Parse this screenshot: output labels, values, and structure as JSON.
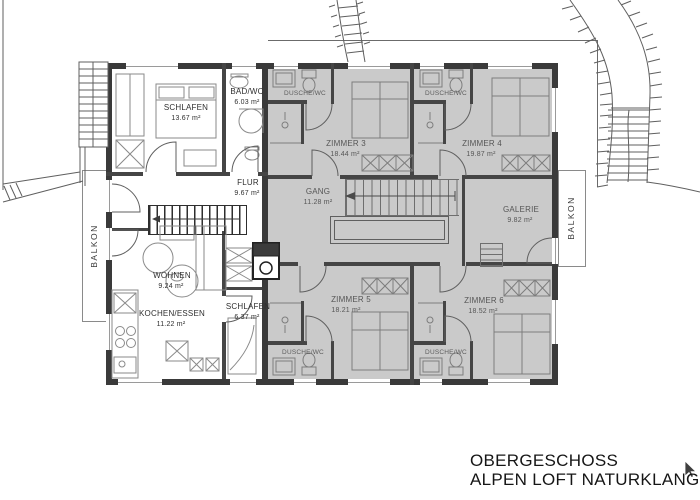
{
  "title": {
    "line1": "OBERGESCHOSS",
    "line2": "ALPEN LOFT NATURKLANG"
  },
  "left_apartment": {
    "schlafen_1": {
      "name": "SCHLAFEN",
      "area": "13.67 m²"
    },
    "bad_wc": {
      "name": "BAD/WC",
      "area": "6.03 m²"
    },
    "flur": {
      "name": "FLUR",
      "area": "9.67 m²"
    },
    "wohnen": {
      "name": "WOHNEN",
      "area": "9.24 m²"
    },
    "kochen_essen": {
      "name": "KOCHEN/ESSEN",
      "area": "11.22 m²"
    },
    "schlafen_2": {
      "name": "SCHLAFEN",
      "area": "6.37 m²"
    }
  },
  "guest_rooms": {
    "zimmer_3": {
      "name": "ZIMMER 3",
      "area": "18.44 m²"
    },
    "zimmer_4": {
      "name": "ZIMMER 4",
      "area": "19.87 m²"
    },
    "gang": {
      "name": "GANG",
      "area": "11.28 m²"
    },
    "galerie": {
      "name": "GALERIE",
      "area": "9.82 m²"
    },
    "zimmer_5": {
      "name": "ZIMMER 5",
      "area": "18.21 m²"
    },
    "zimmer_6": {
      "name": "ZIMMER 6",
      "area": "18.52 m²"
    },
    "dusche_wc_1": {
      "name": "DUSCHE/WC"
    },
    "dusche_wc_2": {
      "name": "DUSCHE/WC"
    },
    "dusche_wc_3": {
      "name": "DUSCHE/WC"
    },
    "dusche_wc_4": {
      "name": "DUSCHE/WC"
    }
  },
  "balconies": {
    "left": {
      "name": "BALKON"
    },
    "right": {
      "name": "BALKON"
    }
  },
  "colors": {
    "room_highlight": "#cacaca",
    "wall": "#3a3a3a",
    "line": "#6b6b6b"
  }
}
